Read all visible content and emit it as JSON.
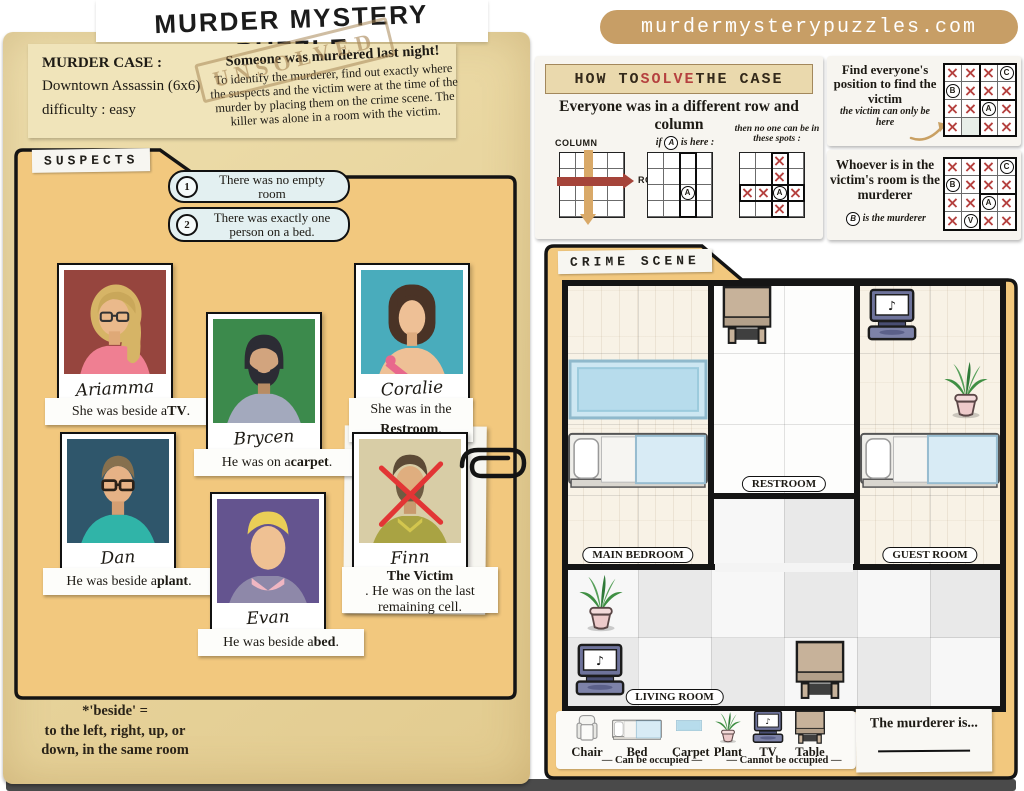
{
  "page": {
    "title": "MURDER MYSTERY PUZZLE",
    "stamp": "UNSOLVED"
  },
  "case_note": {
    "label": "MURDER CASE :",
    "name": "Downtown Assassin (6x6)",
    "difficulty": "difficulty : easy",
    "headline": "Someone was murdered last night!",
    "body": "To identify the murderer, find out exactly where the suspects and the victim were at the time of the murder by placing them on the crime scene. The killer was alone in a room with the victim."
  },
  "suspects_panel": {
    "tab": "SUSPECTS",
    "clues": [
      {
        "num": "1",
        "text": "There was no empty room"
      },
      {
        "num": "2",
        "text": "There was exactly one person on a bed."
      }
    ],
    "footnote": {
      "l1": "*'beside' =",
      "l2": "to the left, right, up, or",
      "l3": "down, in the same room"
    }
  },
  "suspects": [
    {
      "name": "Ariamma",
      "clue_pre": "She was beside a ",
      "clue_bold": "TV",
      "clue_post": "."
    },
    {
      "name": "Brycen",
      "clue_pre": "He was on a ",
      "clue_bold": "carpet",
      "clue_post": "."
    },
    {
      "name": "Coralie",
      "clue_pre": "She was in the ",
      "clue_bold": "Restroom",
      "clue_post": "."
    },
    {
      "name": "Dan",
      "clue_pre": "He was beside a ",
      "clue_bold": "plant",
      "clue_post": "."
    },
    {
      "name": "Evan",
      "clue_pre": "He was beside a ",
      "clue_bold": "bed",
      "clue_post": "."
    },
    {
      "name": "Finn",
      "clue_pre": "",
      "clue_bold": "The Victim",
      "clue_post": ". He was on the last remaining cell."
    }
  ],
  "site": {
    "domain": "murdermysterypuzzles.com"
  },
  "how_to": {
    "banner_pre": "HOW TO ",
    "banner_accent": "SOLVE",
    "banner_post": " THE CASE",
    "subtitle": "Everyone was in a different row and column",
    "demo_rc": {
      "column_label": "COLUMN",
      "row_label": "ROW"
    },
    "demo_if": {
      "pre": "if ",
      "letter": "A",
      "post": " is here :",
      "cells": [
        [
          "",
          "",
          "",
          ""
        ],
        [
          "",
          "",
          "",
          ""
        ],
        [
          "",
          "",
          "A",
          ""
        ],
        [
          "",
          "",
          "",
          ""
        ]
      ]
    },
    "demo_then": {
      "caption": "then no one can be in these spots :",
      "cells": [
        [
          "",
          "",
          "X",
          ""
        ],
        [
          "",
          "",
          "X",
          ""
        ],
        [
          "X",
          "X",
          "A",
          "X"
        ],
        [
          "",
          "",
          "X",
          ""
        ]
      ]
    }
  },
  "panels": {
    "find": {
      "title": "Find everyone's position to find the victim",
      "note": "the victim can only be here",
      "cells": [
        [
          "X",
          "X",
          "X",
          "C"
        ],
        [
          "B",
          "X",
          "X",
          "X"
        ],
        [
          "X",
          "X",
          "A",
          "X"
        ],
        [
          "X",
          "_",
          "X",
          "X"
        ]
      ]
    },
    "whoever": {
      "title": "Whoever is in the victim's room is the murderer",
      "note_letter": "B",
      "note_text": " is the murderer",
      "cells": [
        [
          "X",
          "X",
          "X",
          "C"
        ],
        [
          "B",
          "X",
          "X",
          "X"
        ],
        [
          "X",
          "X",
          "A",
          "X"
        ],
        [
          "X",
          "V",
          "X",
          "X"
        ]
      ]
    }
  },
  "crime_scene": {
    "tab": "CRIME SCENE",
    "rooms": [
      {
        "name": "MAIN BEDROOM",
        "rects": [
          [
            0,
            0,
            2,
            4
          ]
        ],
        "floor": "plank",
        "label_cx": 1.0,
        "label_row": 4
      },
      {
        "name": "RESTROOM",
        "rects": [
          [
            2,
            0,
            2,
            3
          ]
        ],
        "floor": "tile",
        "label_cx": 3.0,
        "label_row": 3
      },
      {
        "name": "GUEST ROOM",
        "rects": [
          [
            4,
            0,
            2,
            4
          ]
        ],
        "floor": "plank",
        "label_cx": 5.0,
        "label_row": 4
      },
      {
        "name": "LIVING ROOM",
        "rects": [
          [
            2,
            3,
            2,
            1
          ],
          [
            0,
            4,
            6,
            2
          ]
        ],
        "floor": "checker",
        "label_cx": 1.5,
        "label_row": 6
      }
    ],
    "furniture": [
      {
        "type": "carpet",
        "col": 0,
        "row": 1,
        "span": 2
      },
      {
        "type": "bed",
        "col": 0,
        "row": 2,
        "span": 2
      },
      {
        "type": "table",
        "col": 2,
        "row": 0,
        "span": 1
      },
      {
        "type": "tv",
        "col": 4,
        "row": 0,
        "span": 1
      },
      {
        "type": "plant",
        "col": 5,
        "row": 1,
        "span": 1
      },
      {
        "type": "bed",
        "col": 4,
        "row": 2,
        "span": 2
      },
      {
        "type": "plant",
        "col": 0,
        "row": 4,
        "span": 1
      },
      {
        "type": "tv",
        "col": 0,
        "row": 5,
        "span": 1
      },
      {
        "type": "table",
        "col": 3,
        "row": 5,
        "span": 1
      }
    ],
    "legend": {
      "items": [
        {
          "type": "chair",
          "label": "Chair"
        },
        {
          "type": "bed",
          "label": "Bed"
        },
        {
          "type": "carpet",
          "label": "Carpet"
        },
        {
          "type": "plant",
          "label": "Plant"
        },
        {
          "type": "tv",
          "label": "TV"
        },
        {
          "type": "table",
          "label": "Table"
        }
      ],
      "can_label": "— Can be occupied —",
      "cannot_label": "— Cannot be occupied —"
    },
    "murderer_prompt": "The murderer is..."
  },
  "colors": {
    "accent_red": "#b5413f",
    "folder": "#f2c87e",
    "banner": "#c79e66"
  }
}
